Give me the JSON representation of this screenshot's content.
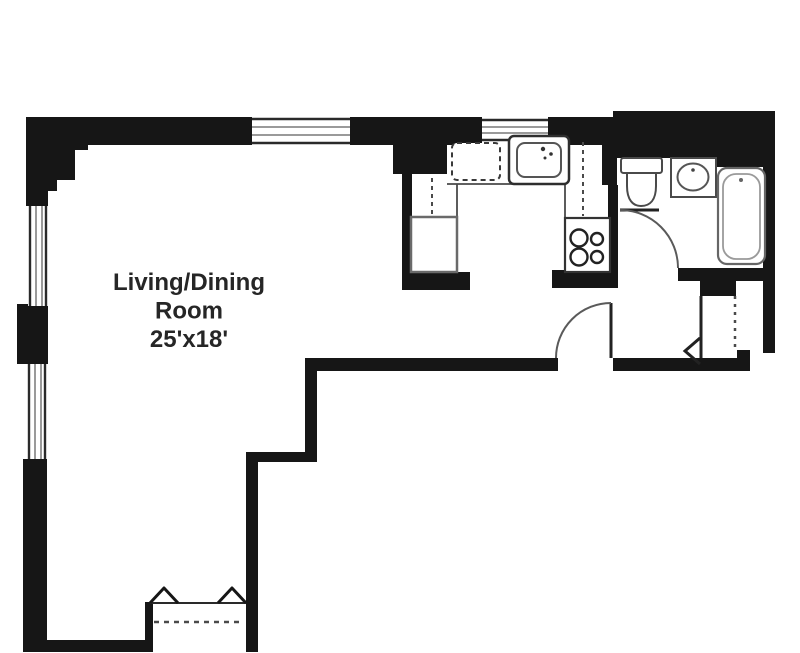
{
  "floor_plan": {
    "room_label": {
      "line1": "Living/Dining",
      "line2": "Room",
      "line3": "25'x18'",
      "full_text": "Living/Dining Room 25'x18'"
    },
    "colors": {
      "background": "#ffffff",
      "wall": "#161616",
      "fixture_stroke": "#4a4a4a",
      "fixture_light_stroke": "#9a9a9a",
      "window_mullion": "#9a9a9a",
      "label_text": "#262626"
    },
    "fixtures": [
      {
        "name": "refrigerator",
        "room": "kitchen"
      },
      {
        "name": "dishwasher",
        "room": "kitchen"
      },
      {
        "name": "kitchen-sink",
        "room": "kitchen"
      },
      {
        "name": "stove-4-burner",
        "room": "kitchen"
      },
      {
        "name": "toilet",
        "room": "bathroom"
      },
      {
        "name": "vanity-sink",
        "room": "bathroom"
      },
      {
        "name": "bathtub",
        "room": "bathroom"
      },
      {
        "name": "closet-dashed-door",
        "room": "foyer"
      },
      {
        "name": "entry-arrow",
        "room": "foyer"
      },
      {
        "name": "radiator-ac-unit",
        "room": "living-dining-room"
      }
    ],
    "window_count": 4,
    "door_count": 2
  }
}
